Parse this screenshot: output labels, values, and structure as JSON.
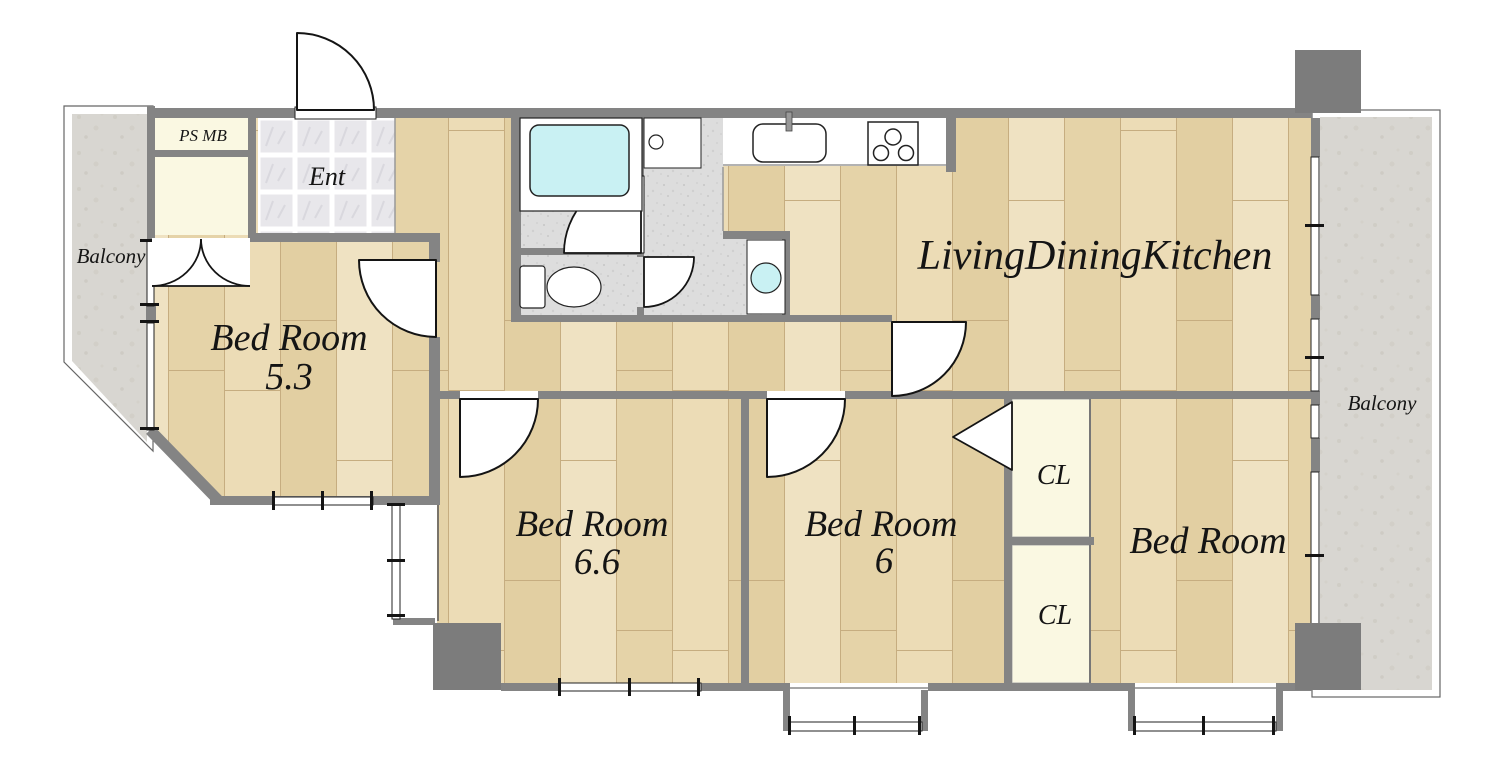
{
  "floorplan": {
    "labels": {
      "balcony_left": "Balcony",
      "balcony_right": "Balcony",
      "ps_mb": "PS MB",
      "entrance": "Ent",
      "ldk": "LivingDiningKitchen",
      "bedroom_53_name": "Bed Room",
      "bedroom_53_size": "5.3",
      "bedroom_66_name": "Bed Room",
      "bedroom_66_size": "6.6",
      "bedroom_6_name": "Bed Room",
      "bedroom_6_size": "6",
      "bedroom_right_name": "Bed Room",
      "closet_upper": "CL",
      "closet_lower": "CL"
    },
    "colors": {
      "wall": "#848484",
      "pillar": "#7c7c7c",
      "wood_floor": "#e7d6ac",
      "bath_floor": "#dcdcdc",
      "entrance_tile": "#e8e7eb",
      "balcony_floor": "#d8d6d1",
      "closet_fill": "#faf8e2",
      "water_fixture": "#c9f1f3"
    }
  }
}
